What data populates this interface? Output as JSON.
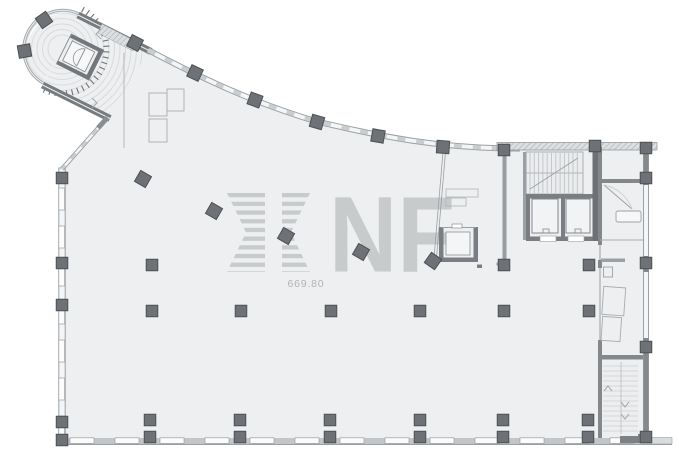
{
  "document": {
    "type": "architectural-floor-plan",
    "title": "Office floor plan"
  },
  "watermark": {
    "stylized_letter": "M",
    "letters": "NF",
    "elevation_label": "669.80",
    "color": "#c8cbcc"
  },
  "colors": {
    "background": "#ffffff",
    "floor": "#edeff0",
    "wall_dark": "#777b7f",
    "wall_medium": "#84888b",
    "facade_line": "#9aa0a3",
    "facade_fill": "#f4f5f6",
    "mullion": "#c9cdcf",
    "tread": "#cbcfd0",
    "column_fill": "#6e7276",
    "column_stroke": "#4d5154",
    "watermark": "#c8cbcc",
    "level_text": "#b0b4b6"
  },
  "plan": {
    "stairs": [
      {
        "name": "northwest-curved-stair"
      },
      {
        "name": "core-stair"
      },
      {
        "name": "southeast-stair"
      }
    ],
    "elevators": [
      {
        "name": "northwest-elevator"
      },
      {
        "name": "core-elevator-left"
      },
      {
        "name": "core-elevator-right"
      },
      {
        "name": "service-elevator"
      }
    ],
    "stair_arrows": {
      "up_icon": "chevron-up",
      "down_icon": "chevron-down"
    },
    "columns_square": [
      [
        62,
        178
      ],
      [
        62,
        263
      ],
      [
        62,
        305
      ],
      [
        62,
        422
      ],
      [
        62,
        440
      ],
      [
        152,
        265
      ],
      [
        504,
        265
      ],
      [
        589,
        265
      ],
      [
        152,
        311
      ],
      [
        241,
        311
      ],
      [
        331,
        311
      ],
      [
        420,
        311
      ],
      [
        504,
        311
      ],
      [
        589,
        311
      ],
      [
        150,
        420
      ],
      [
        240,
        420
      ],
      [
        330,
        420
      ],
      [
        420,
        420
      ],
      [
        503,
        420
      ],
      [
        588,
        420
      ],
      [
        150,
        437
      ],
      [
        240,
        437
      ],
      [
        330,
        437
      ],
      [
        420,
        437
      ],
      [
        503,
        437
      ],
      [
        588,
        437
      ],
      [
        646,
        148
      ],
      [
        646,
        178
      ],
      [
        646,
        263
      ],
      [
        646,
        347
      ],
      [
        646,
        437
      ],
      [
        595,
        146
      ],
      [
        504,
        150
      ]
    ],
    "columns_rotated": [
      [
        143,
        179,
        30
      ],
      [
        214,
        211,
        30
      ],
      [
        286,
        236,
        30
      ],
      [
        361,
        252,
        30
      ],
      [
        433,
        261,
        35
      ],
      [
        135,
        43,
        27
      ],
      [
        195,
        73,
        25
      ],
      [
        255,
        100,
        20
      ],
      [
        317,
        122,
        16
      ],
      [
        378,
        136,
        10
      ],
      [
        443,
        147,
        4
      ],
      [
        44,
        20,
        -35
      ],
      [
        24.5,
        51,
        80
      ]
    ]
  }
}
